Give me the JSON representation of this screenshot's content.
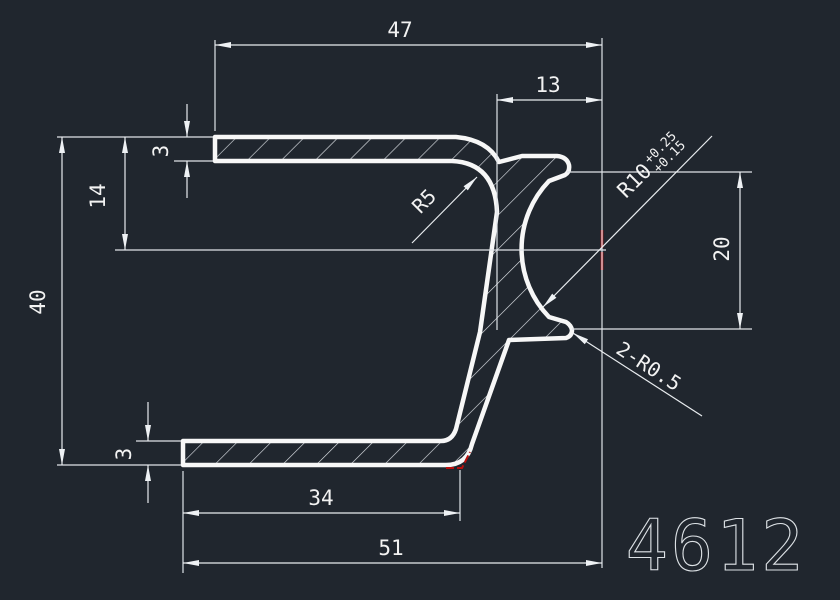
{
  "drawing": {
    "part_number": "4612",
    "background_color": "#20262e",
    "line_color": "#f2f2f2",
    "highlight_color": "#b8100e",
    "dims": {
      "top_flange_width": "47",
      "lip_offset": "13",
      "top_flange_thickness": "3",
      "flange_to_groove_center": "14",
      "overall_height": "40",
      "bottom_flange_thickness": "3",
      "bottom_flange_inner_length": "34",
      "bottom_flange_width": "51",
      "groove_opening_height": "20",
      "inner_fillet_radius": "R5",
      "groove_radius": "R10",
      "groove_radius_tol_upper": "+0.25",
      "groove_radius_tol_lower": "+0.15",
      "lip_fillets": "2-R0.5"
    }
  }
}
